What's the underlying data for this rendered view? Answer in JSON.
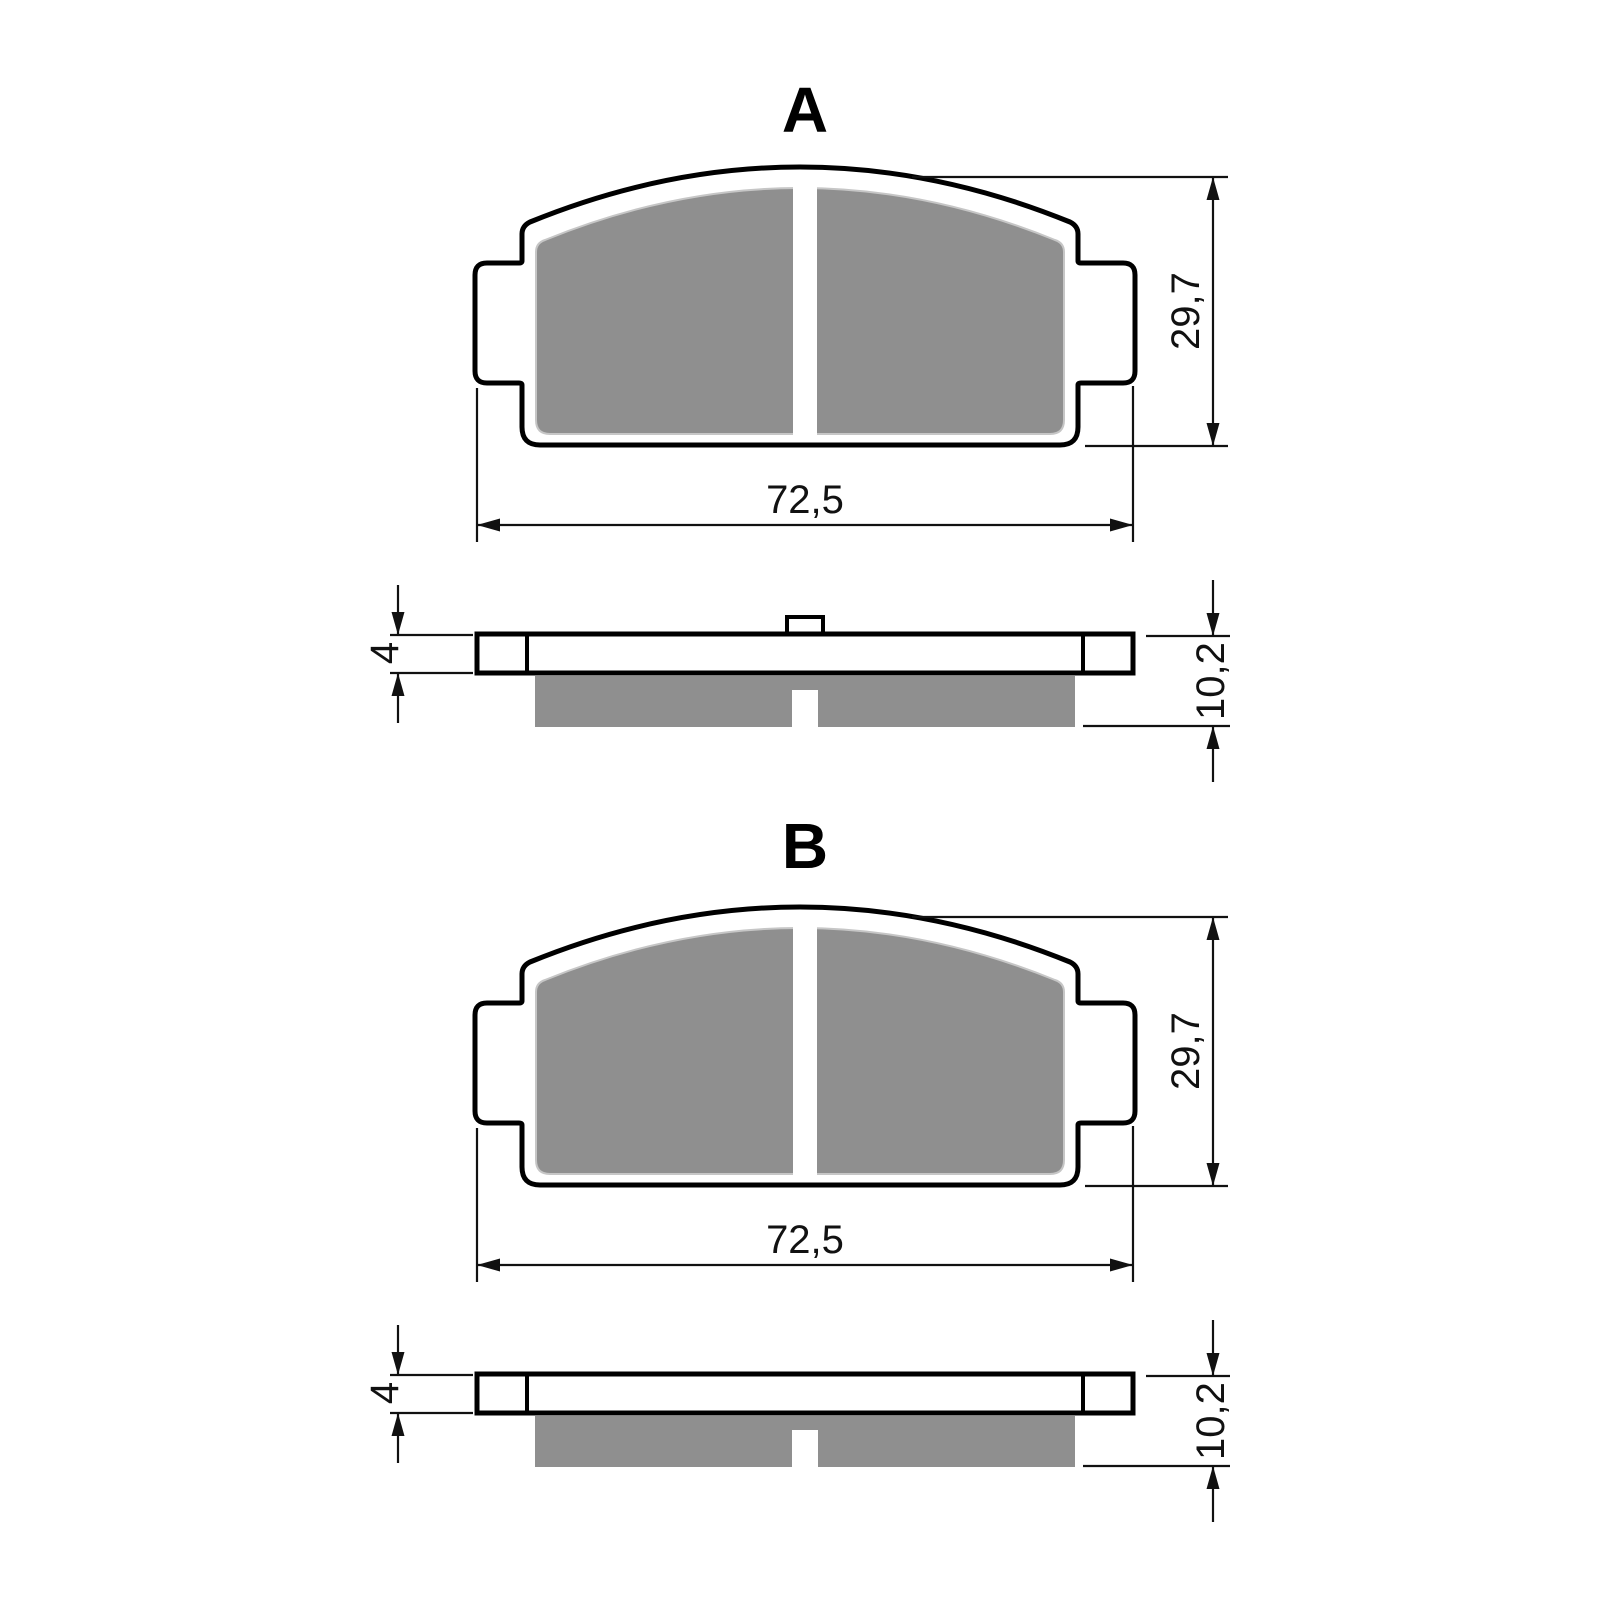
{
  "figure": {
    "type": "technical-drawing",
    "subject": "Brake pad dimensional drawing with two variants",
    "colors": {
      "outline": "#000000",
      "friction_material": "#8f8f8f",
      "dimension_lines": "#111111",
      "background": "#ffffff"
    },
    "views": [
      {
        "label": "A",
        "has_spring_tab": true,
        "dimensions": {
          "width": "72,5",
          "height": "29,7",
          "backing_plate_thickness": "4",
          "total_thickness": "10,2"
        }
      },
      {
        "label": "B",
        "has_spring_tab": false,
        "dimensions": {
          "width": "72,5",
          "height": "29,7",
          "backing_plate_thickness": "4",
          "total_thickness": "10,2"
        }
      }
    ]
  }
}
